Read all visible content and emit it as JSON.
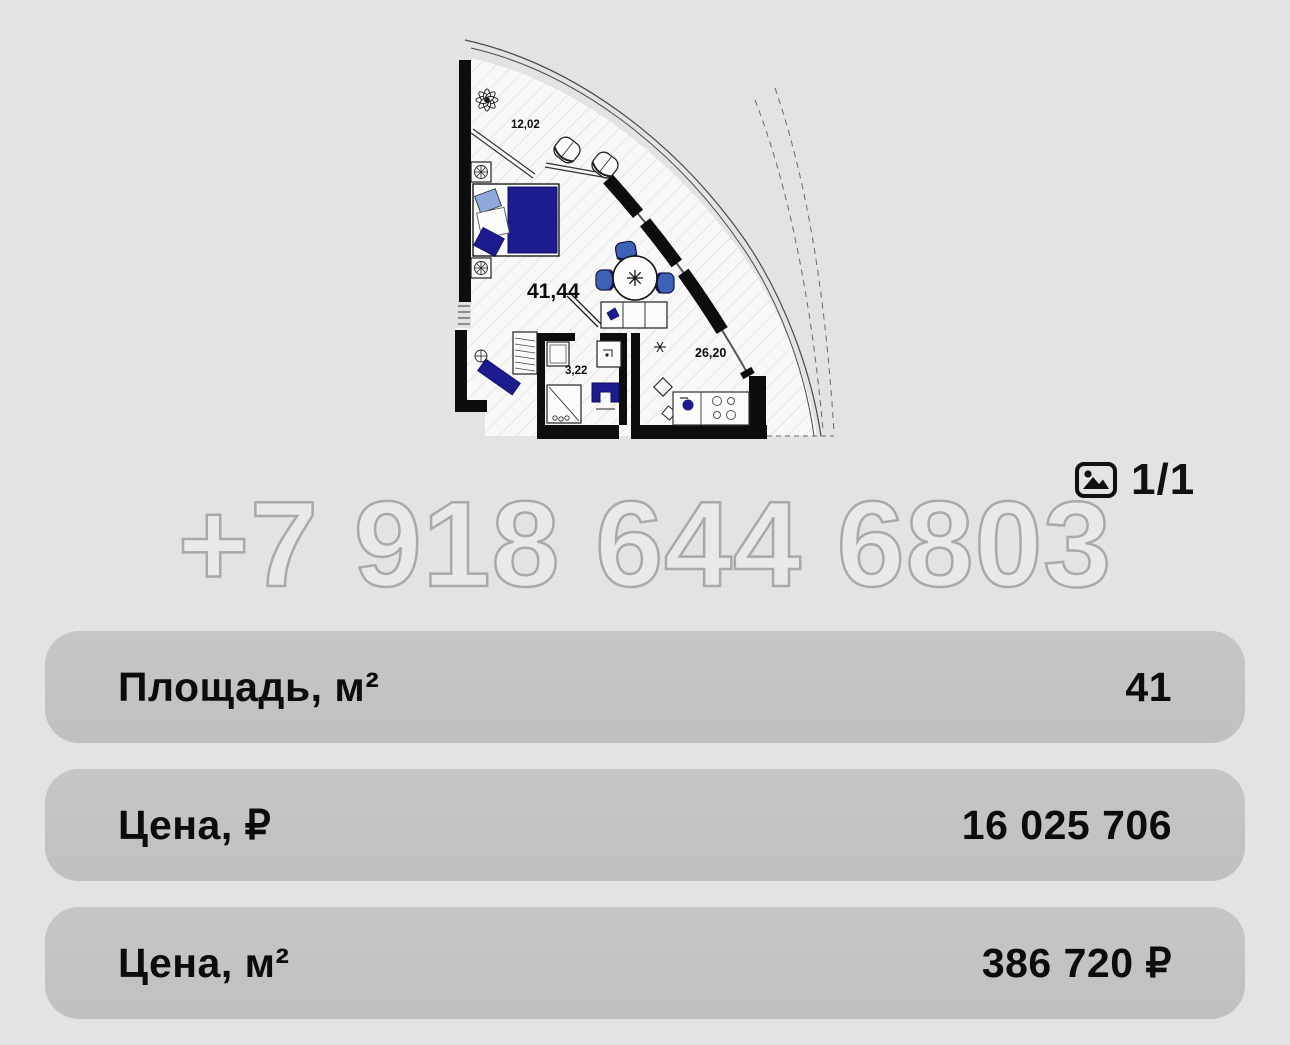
{
  "page": {
    "background": "#e3e3e1"
  },
  "floorplan": {
    "labels": {
      "balcony_area": "12,02",
      "total_area": "41,44",
      "bathroom_area": "3,22",
      "living_area": "26,20"
    },
    "colors": {
      "furniture_navy": "#1c1c8f",
      "chair_blue": "#3c63b5",
      "pillow_light_blue": "#8fa9da",
      "wall_black": "#0d0d0d"
    }
  },
  "watermark": {
    "phone": "+7 918 644 6803"
  },
  "gallery": {
    "counter": "1/1",
    "icon": "photo-icon"
  },
  "info_rows": [
    {
      "label": "Площадь, м²",
      "value": "41"
    },
    {
      "label": "Цена, ₽",
      "value": "16 025 706"
    },
    {
      "label": "Цена, м²",
      "value": "386 720 ₽"
    }
  ]
}
